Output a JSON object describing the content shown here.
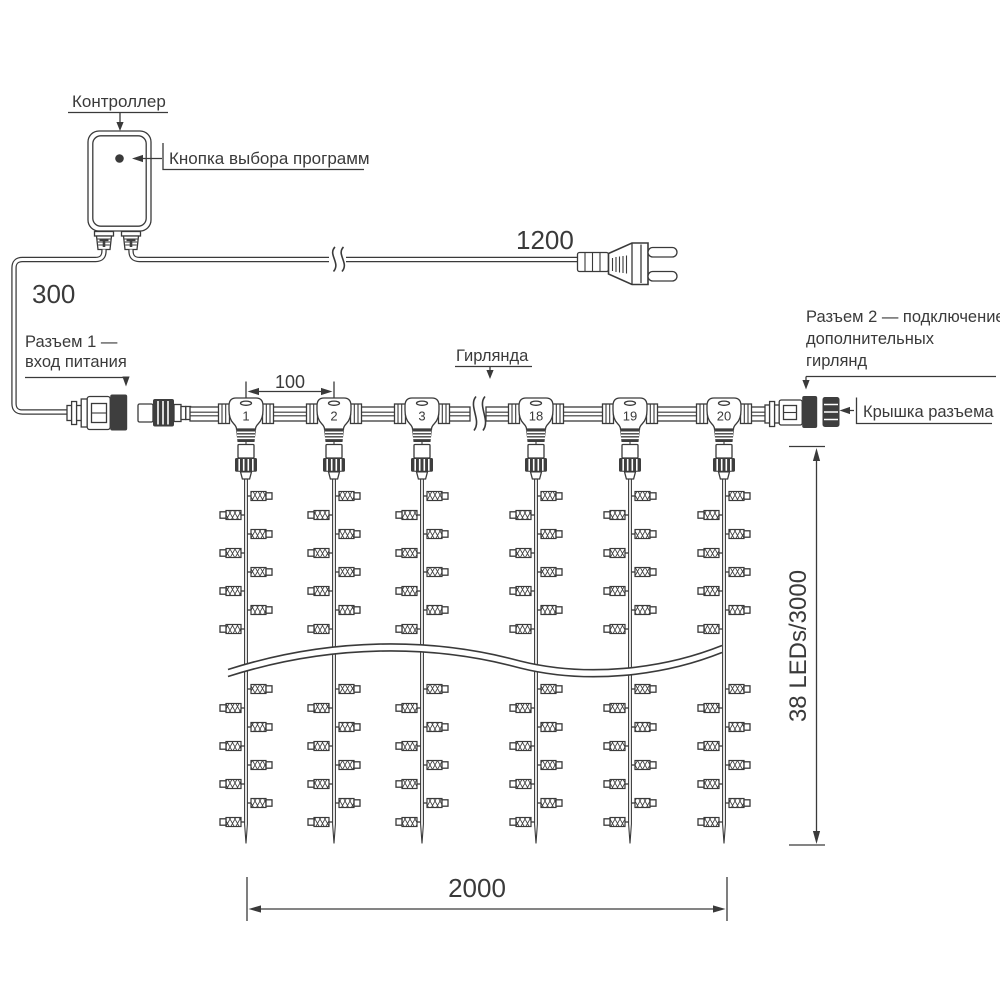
{
  "diagram": {
    "controller_label": "Контроллер",
    "program_button_label": "Кнопка выбора программ",
    "cord_length_mm": "1200",
    "input_lead_length_mm": "300",
    "connector1_label_line1": "Разъем 1 —",
    "connector1_label_line2": "вход питания",
    "garland_label": "Гирлянда",
    "connector2_label_line1": "Разъем 2 — подключение",
    "connector2_label_line2": "дополнительных",
    "connector2_label_line3": "гирлянд",
    "cap_label": "Крышка разъема",
    "drop_spacing_mm": "100",
    "curtain_width_mm": "2000",
    "curtain_height_label": "38 LEDs/3000",
    "tee_numbers": [
      "1",
      "2",
      "3",
      "18",
      "19",
      "20"
    ]
  },
  "colors": {
    "ink": "#3a3a3a",
    "dark_fill": "#3e3e3e",
    "background": "#ffffff"
  }
}
